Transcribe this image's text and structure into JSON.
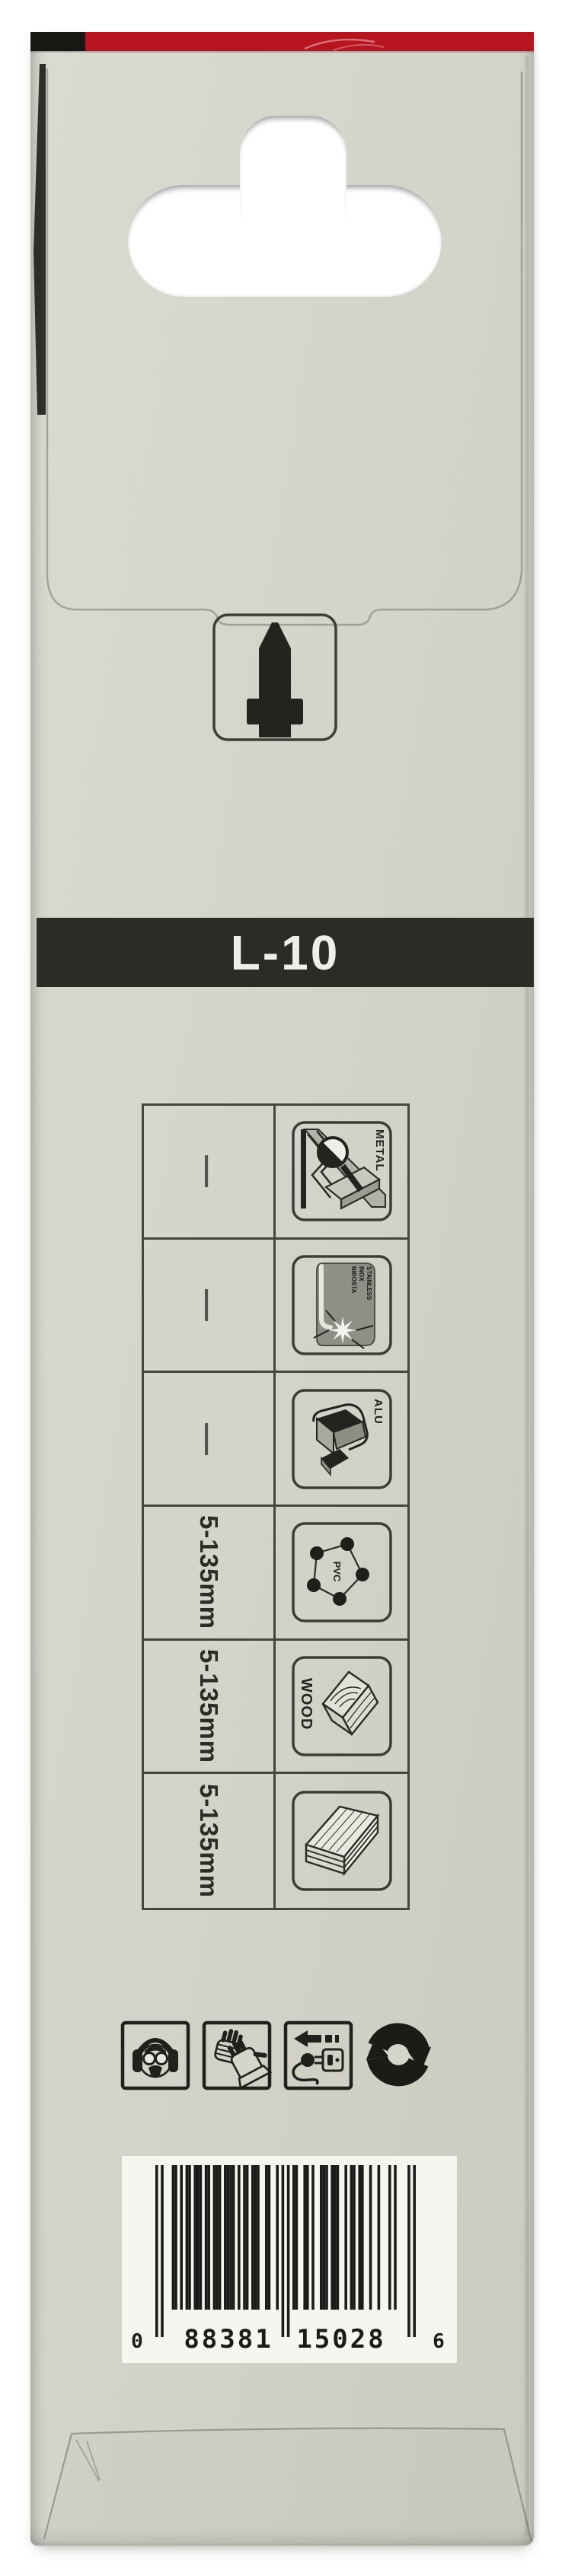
{
  "package": {
    "model": "L-10",
    "colors": {
      "band_red": "#b81420",
      "band_black": "#171714",
      "body": "#d4d4ca",
      "ink": "#23231f",
      "banner_bg": "#2c2b26",
      "banner_text": "#efeee8"
    },
    "spec_table": {
      "rows": [
        {
          "length": "—",
          "material": "METAL"
        },
        {
          "length": "—",
          "material": "STAINLESS INOX NIROSTA",
          "material_lines": [
            "STAINLESS",
            "INOX",
            "NIROSTA"
          ]
        },
        {
          "length": "—",
          "material": "ALU"
        },
        {
          "length": "5-135mm",
          "material": "PVC"
        },
        {
          "length": "5-135mm",
          "material": "WOOD"
        },
        {
          "length": "5-135mm",
          "material": ""
        }
      ]
    },
    "safety_icons": [
      {
        "name": "hearing-and-face-protection-icon"
      },
      {
        "name": "protective-gloves-icon"
      },
      {
        "name": "unplug-power-icon"
      },
      {
        "name": "recycling-icon"
      }
    ],
    "barcode": {
      "value": "088381150286",
      "left_digit": "0",
      "group1": "88381",
      "group2": "15028",
      "right_digit": "6"
    }
  }
}
